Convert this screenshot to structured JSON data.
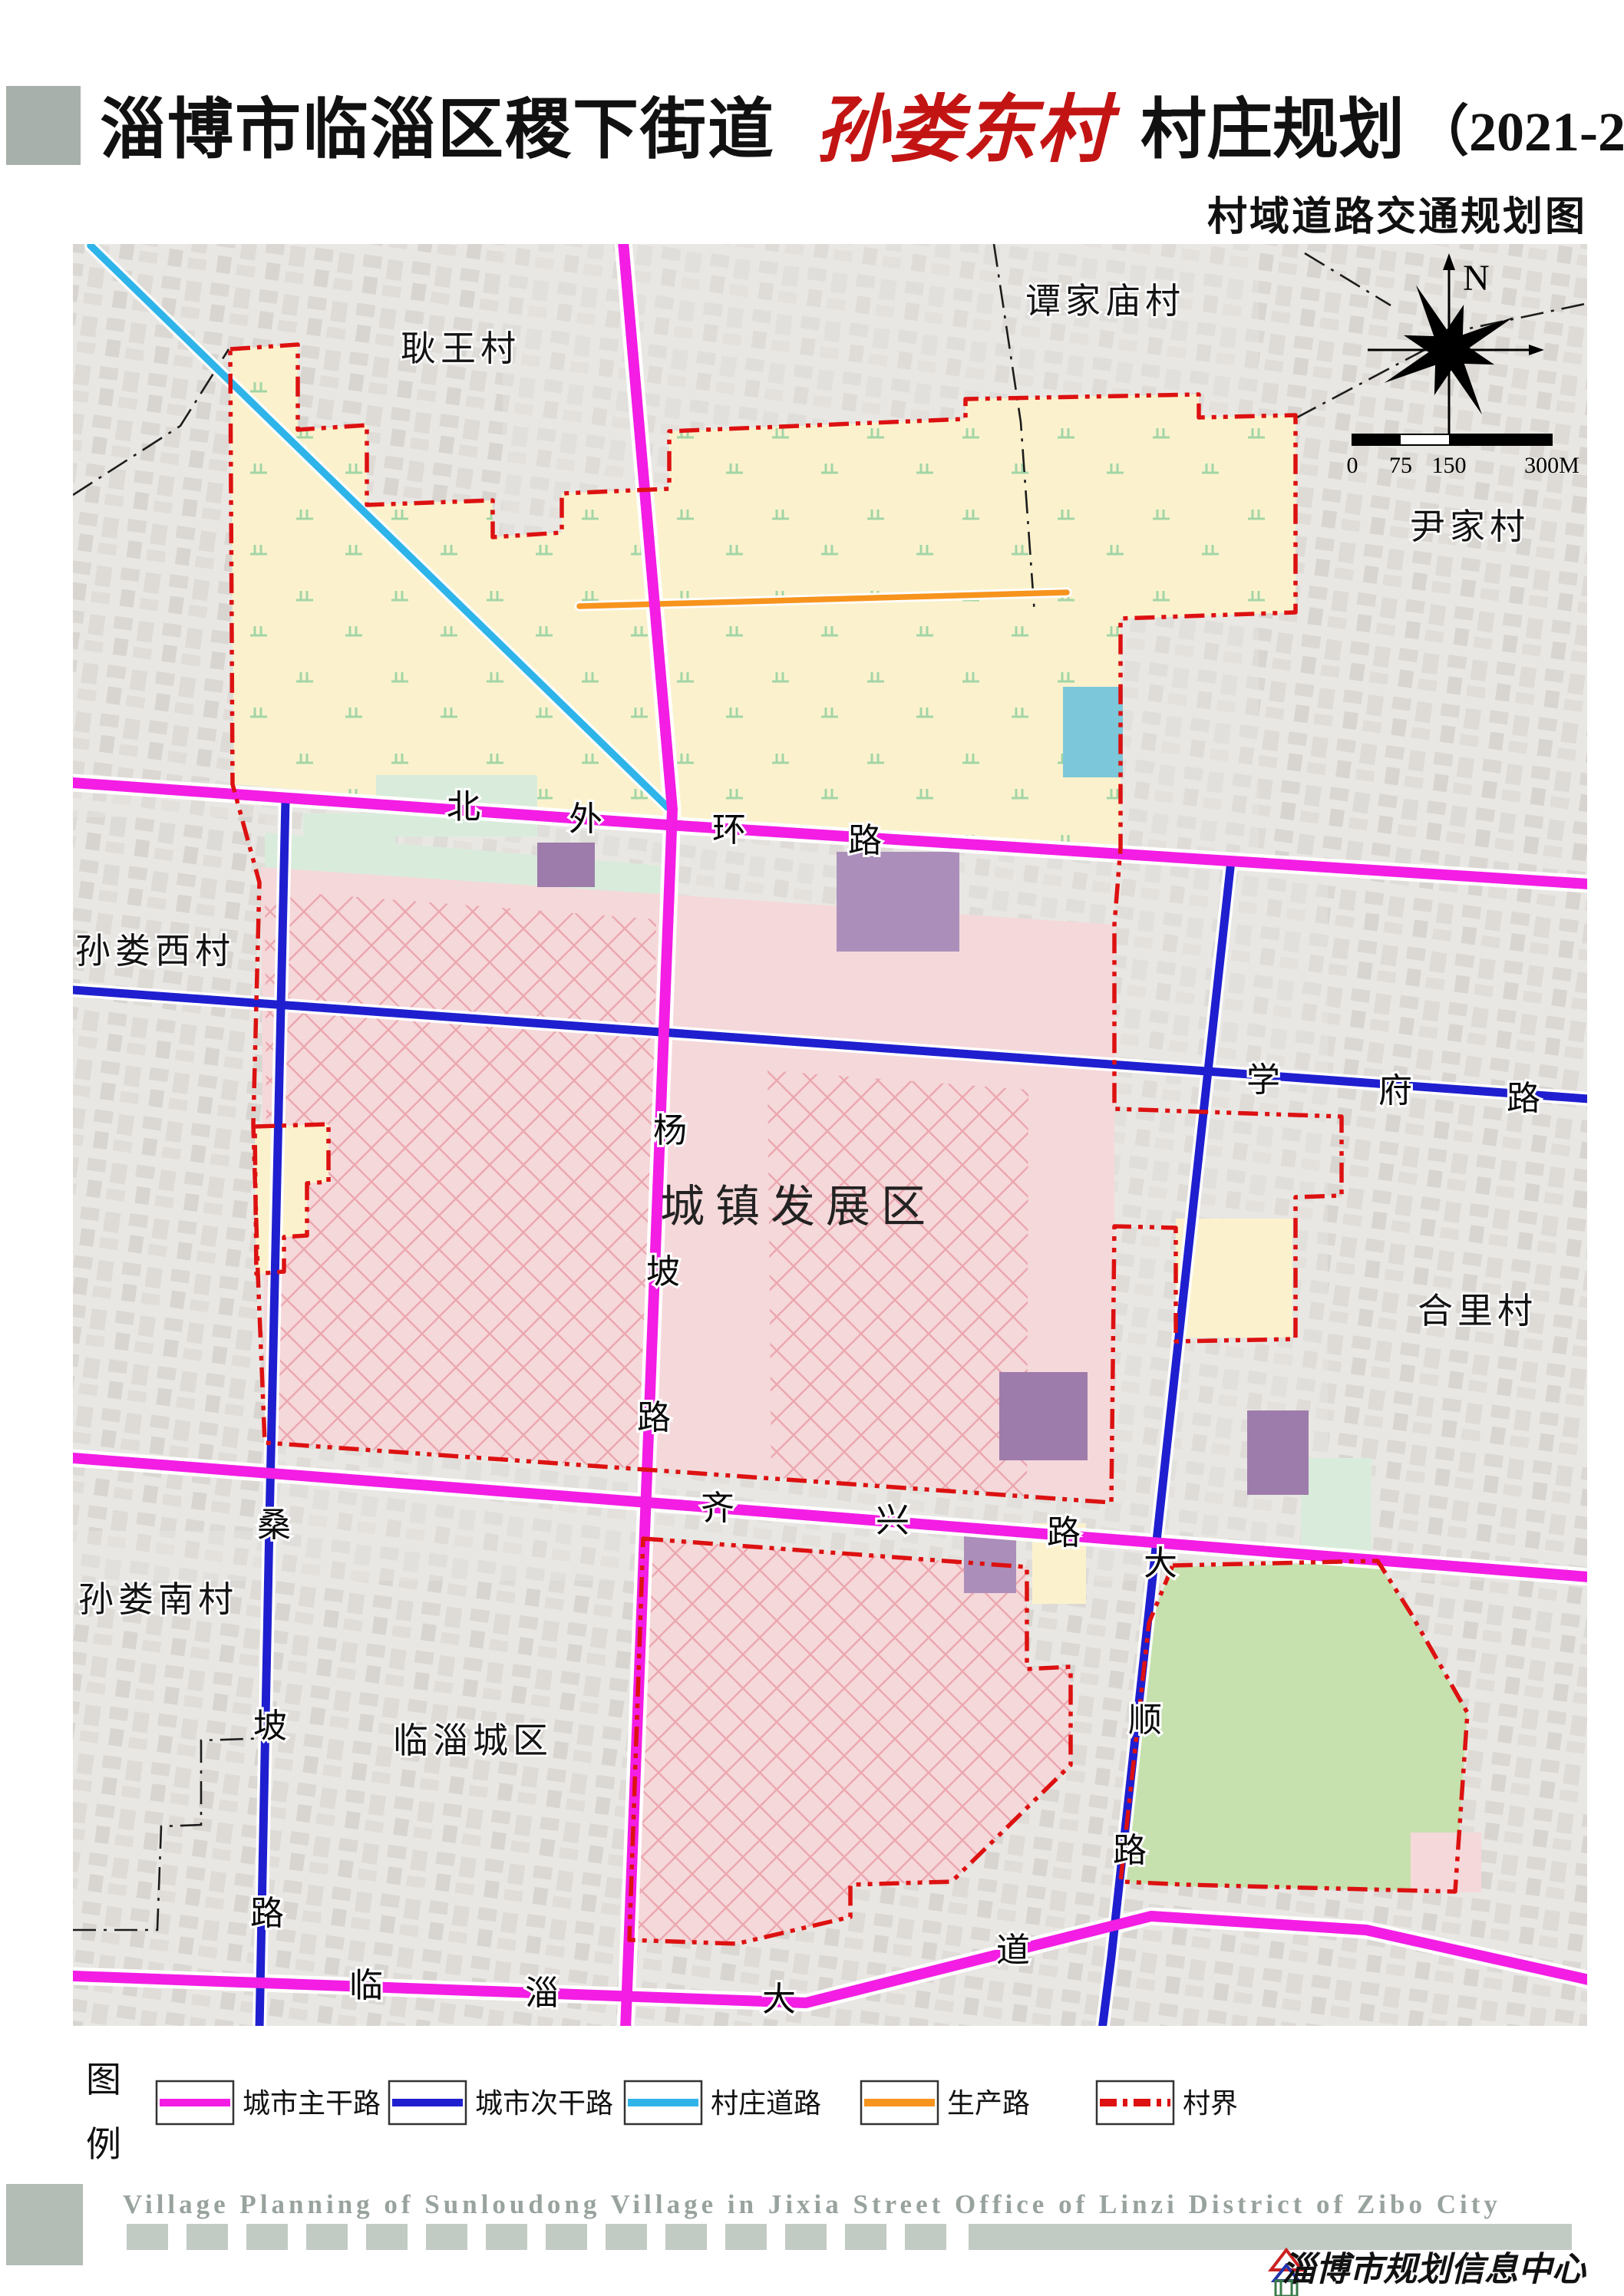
{
  "header": {
    "title_black_1": "淄博市临淄区稷下街道",
    "title_red": "孙娄东村",
    "title_black_2": "村庄规划",
    "title_paren": "（2021-2035年）",
    "subtitle": "村域道路交通规划图"
  },
  "map": {
    "region_label": "城镇发展区",
    "villages": [
      {
        "name": "耿王村"
      },
      {
        "name": "谭家庙村"
      },
      {
        "name": "尹家村"
      },
      {
        "name": "孙娄西村"
      },
      {
        "name": "合里村"
      },
      {
        "name": "孙娄南村"
      },
      {
        "name": "临淄城区"
      }
    ],
    "roads": [
      {
        "name": "北外环路",
        "type": "city-main",
        "chars": [
          "北",
          "外",
          "环",
          "路"
        ]
      },
      {
        "name": "杨坡路",
        "type": "city-main",
        "chars": [
          "杨",
          "坡",
          "路"
        ]
      },
      {
        "name": "齐兴路",
        "type": "city-main",
        "chars": [
          "齐",
          "兴",
          "路"
        ]
      },
      {
        "name": "临淄大道",
        "type": "city-main",
        "chars": [
          "临",
          "淄",
          "大",
          "道"
        ]
      },
      {
        "name": "学府路",
        "type": "city-secondary",
        "chars": [
          "学",
          "府",
          "路"
        ]
      },
      {
        "name": "桑坡路",
        "type": "city-secondary",
        "chars": [
          "桑",
          "坡",
          "路"
        ]
      },
      {
        "name": "大顺路",
        "type": "city-secondary",
        "chars": [
          "大",
          "顺",
          "路"
        ]
      }
    ],
    "compass_label": "N",
    "scale_ticks": [
      "0",
      "75",
      "150",
      "300M"
    ]
  },
  "legend": {
    "label": [
      "图",
      "例"
    ],
    "items": [
      {
        "label": "城市主干路",
        "color": "#f31de4",
        "style": "solid"
      },
      {
        "label": "城市次干路",
        "color": "#1f1fd0",
        "style": "solid"
      },
      {
        "label": "村庄道路",
        "color": "#2fb4e9",
        "style": "solid"
      },
      {
        "label": "生产路",
        "color": "#f7941e",
        "style": "solid"
      },
      {
        "label": "村界",
        "color": "#dd1111",
        "style": "dashdot"
      }
    ]
  },
  "footer": {
    "english": "Village Planning of Sunloudong Village in Jixia Street Office of Linzi District of Zibo City",
    "credit": "淄博市规划信息中心"
  },
  "colors": {
    "farmland_yellow": "#fbf2cd",
    "development_pink": "#f5d8da",
    "green_area": "#c6e1ae",
    "mint": "#d9ecdc",
    "teal_block": "#7cc7d9",
    "purple_block": "#9d7cab"
  }
}
